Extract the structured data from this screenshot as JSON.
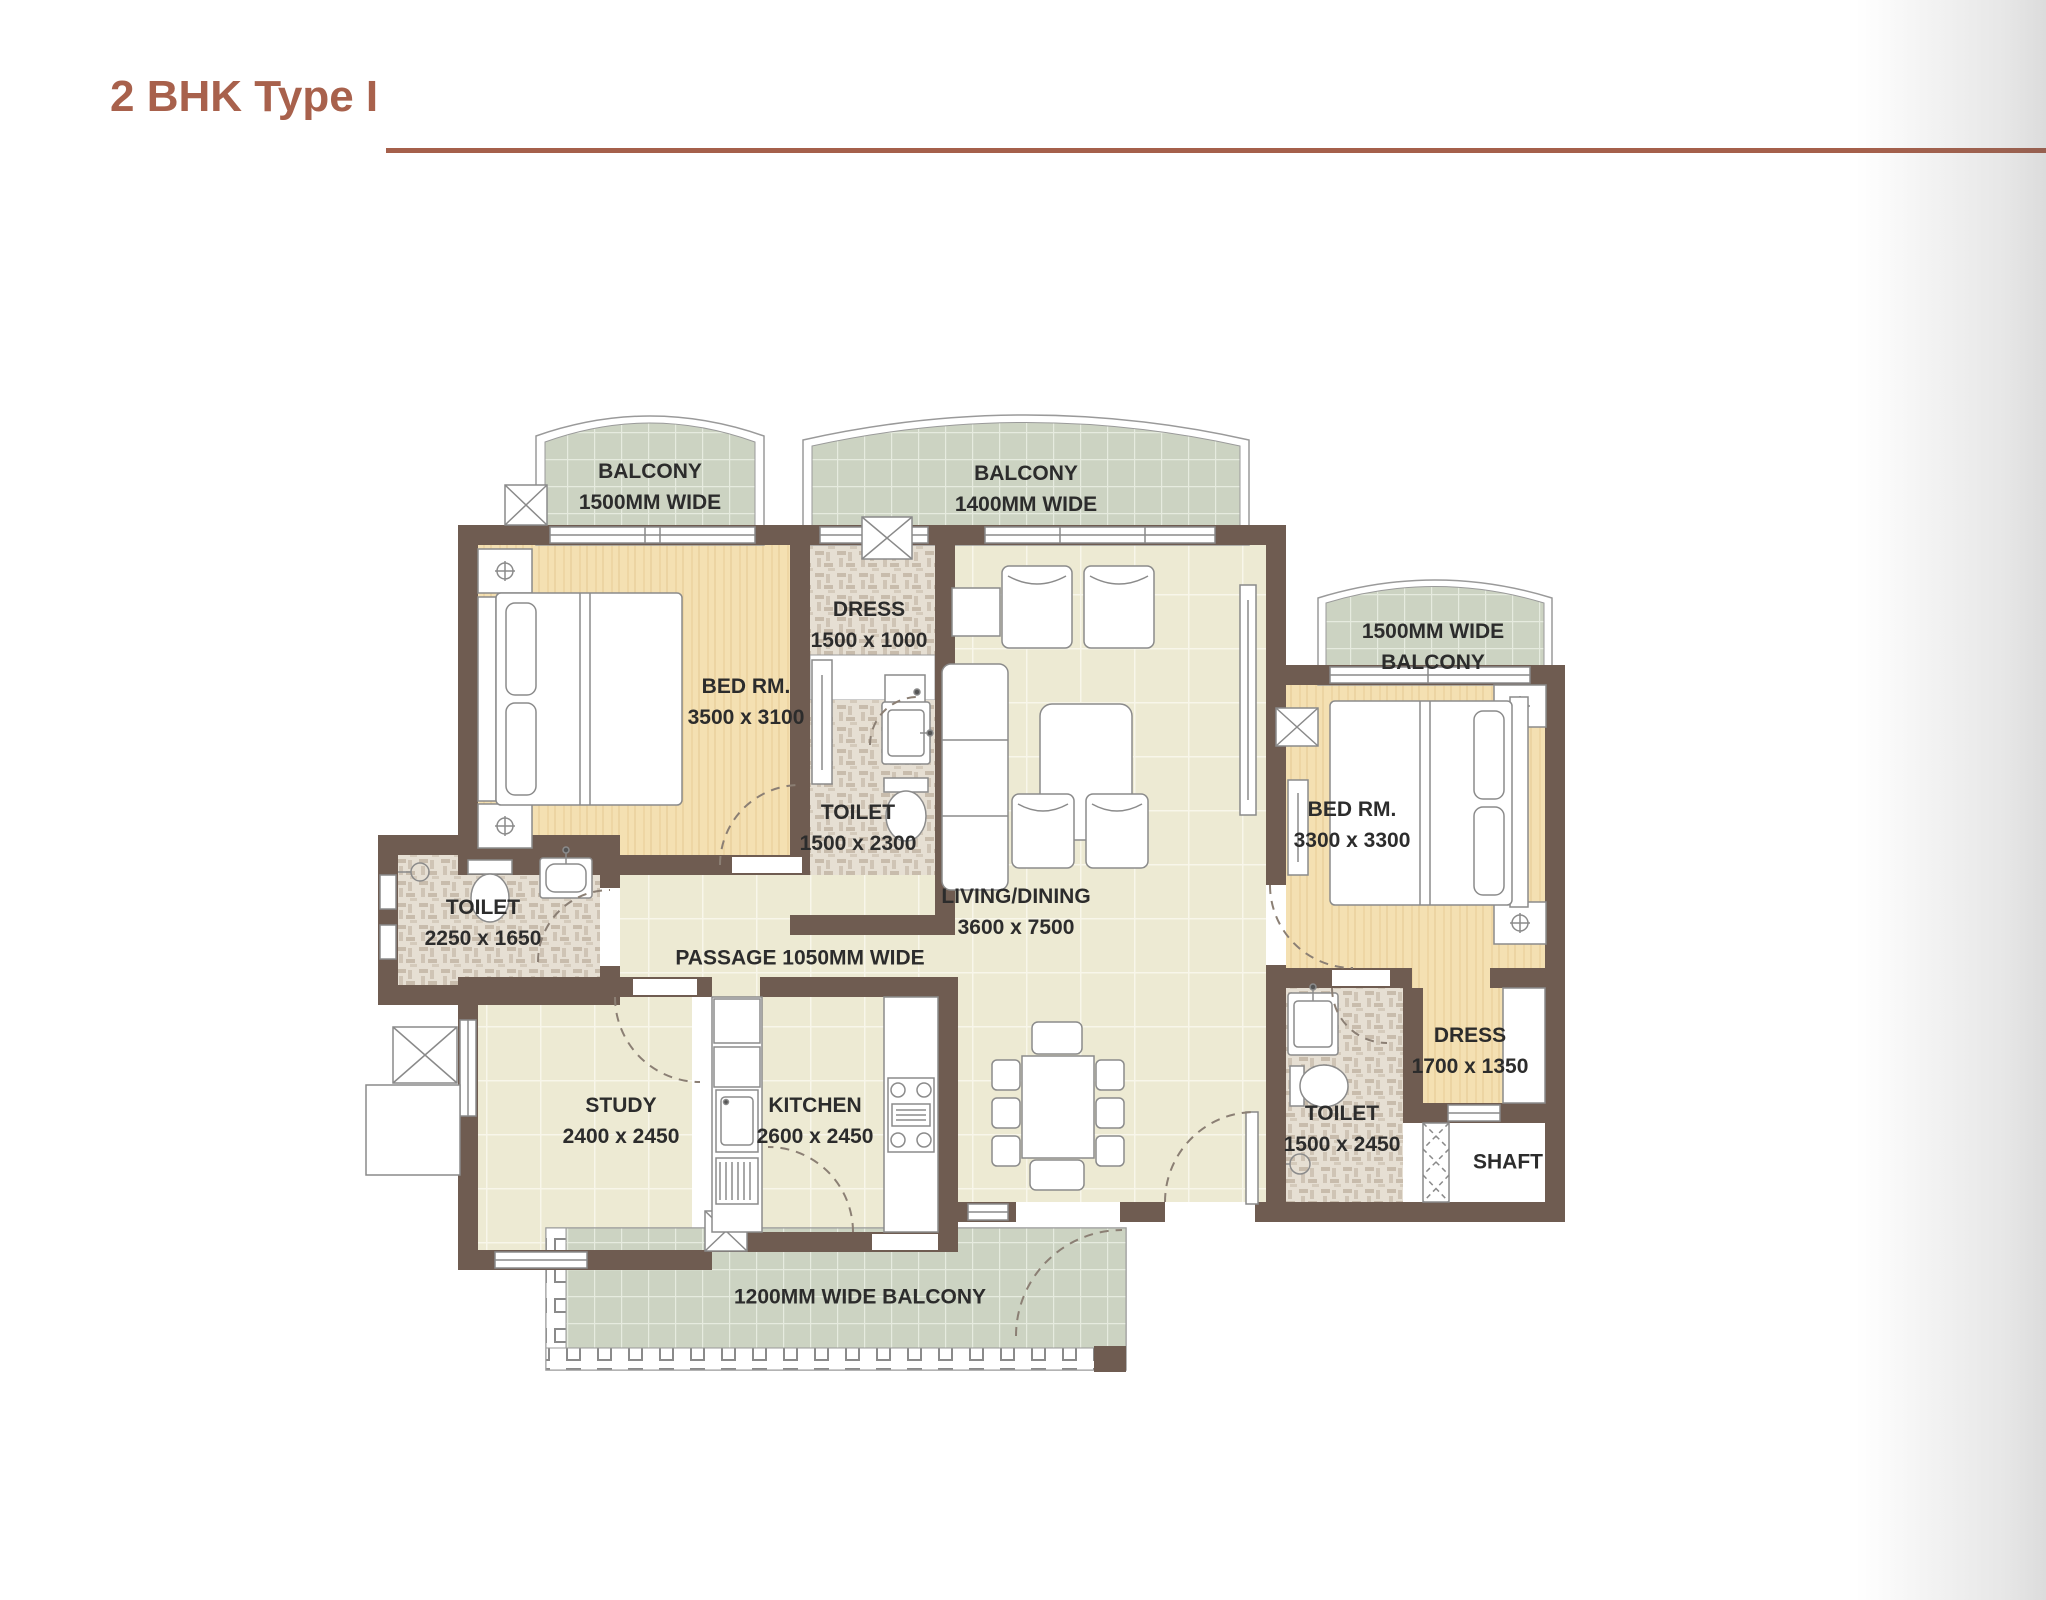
{
  "title": {
    "text": "2 BHK Type I"
  },
  "plan": {
    "balcony_tl": {
      "name": "BALCONY",
      "dims": "1500MM WIDE"
    },
    "balcony_tc": {
      "name": "BALCONY",
      "dims": "1400MM WIDE"
    },
    "balcony_r": {
      "name": "1500MM WIDE",
      "dims": "BALCONY"
    },
    "bedroom1": {
      "name": "BED RM.",
      "dims": "3500 x 3100"
    },
    "dress1": {
      "name": "DRESS",
      "dims": "1500 x 1000"
    },
    "toilet1": {
      "name": "TOILET",
      "dims": "1500 x 2300"
    },
    "toilet2": {
      "name": "TOILET",
      "dims": "2250 x 1650"
    },
    "passage": {
      "name": "PASSAGE 1050MM WIDE"
    },
    "living": {
      "name": "LIVING/DINING",
      "dims": "3600 x 7500"
    },
    "bedroom2": {
      "name": "BED RM.",
      "dims": "3300 x 3300"
    },
    "study": {
      "name": "STUDY",
      "dims": "2400 x 2450"
    },
    "kitchen": {
      "name": "KITCHEN",
      "dims": "2600 x 2450"
    },
    "toilet3": {
      "name": "TOILET",
      "dims": "1500 x 2450"
    },
    "dress2": {
      "name": "DRESS",
      "dims": "1700 x 1350"
    },
    "shaft": {
      "name": "SHAFT"
    },
    "balcony_b": {
      "name": "1200MM WIDE BALCONY"
    }
  },
  "colors": {
    "accent": "#a8614c",
    "wall": "#6f5c51",
    "wood_floor": "#f4e0b2",
    "cream_tile": "#edead3",
    "balcony_tile": "#ccd3c2",
    "mosaic_tile": "#e6dfd3",
    "label_text": "#2c2c2c"
  }
}
